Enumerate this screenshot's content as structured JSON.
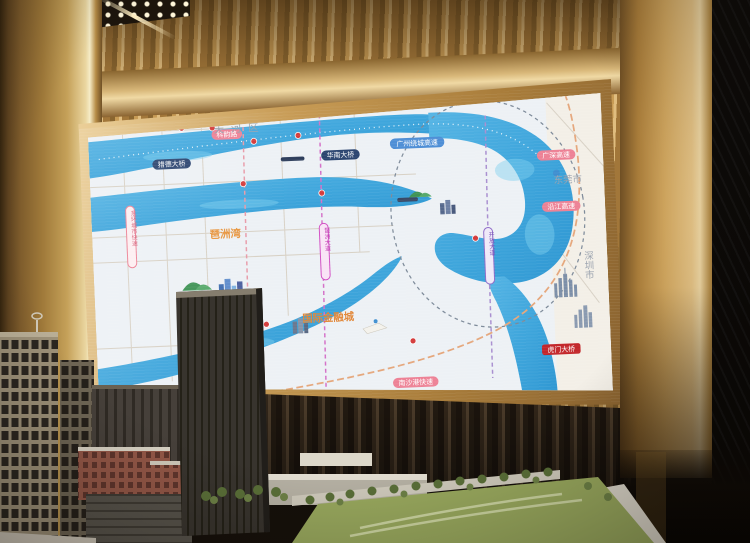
{
  "scene": {
    "colors": {
      "gold_wall": "#c79b55",
      "gold_frame": "#d8b87c",
      "dark_slat_wall": "#2e2317",
      "map_background": "#edf1f5",
      "river_blue": "#3fa6dc",
      "accent_orange": "#e2883a",
      "capsule_pink": "#ed8296",
      "capsule_blue": "#4f8fd6",
      "capsule_navy": "#2c4570",
      "badge_red": "#c3272b",
      "hill_green": "#3f9355",
      "model_field_green": "#99a95e"
    }
  },
  "map": {
    "district_label": "天 河 区",
    "city_labels": {
      "dongguan": "东莞市",
      "shenzhen": "深圳市"
    },
    "area_labels": {
      "financial_city": "国际金融城",
      "pazhou_bay": "琶洲湾"
    },
    "road_labels": [
      {
        "label": "华南快速",
        "style": "pink"
      },
      {
        "label": "科韵路",
        "style": "pink"
      },
      {
        "label": "猎德大桥",
        "style": "navy"
      },
      {
        "label": "华南大桥",
        "style": "navy"
      },
      {
        "label": "广州绕城高速",
        "style": "blue"
      },
      {
        "label": "广深高速",
        "style": "pink"
      },
      {
        "label": "沿江高速",
        "style": "pink"
      },
      {
        "label": "南沙港快速",
        "style": "pink"
      },
      {
        "label": "虎门大桥",
        "style": "red"
      },
      {
        "label": "新光快速",
        "style": "pink"
      }
    ],
    "vertical_labels": [
      {
        "label": "东环城市快速",
        "style": "pink"
      },
      {
        "label": "琶洲大道",
        "style": "magenta"
      },
      {
        "label": "开放大道",
        "style": "purple"
      }
    ]
  }
}
